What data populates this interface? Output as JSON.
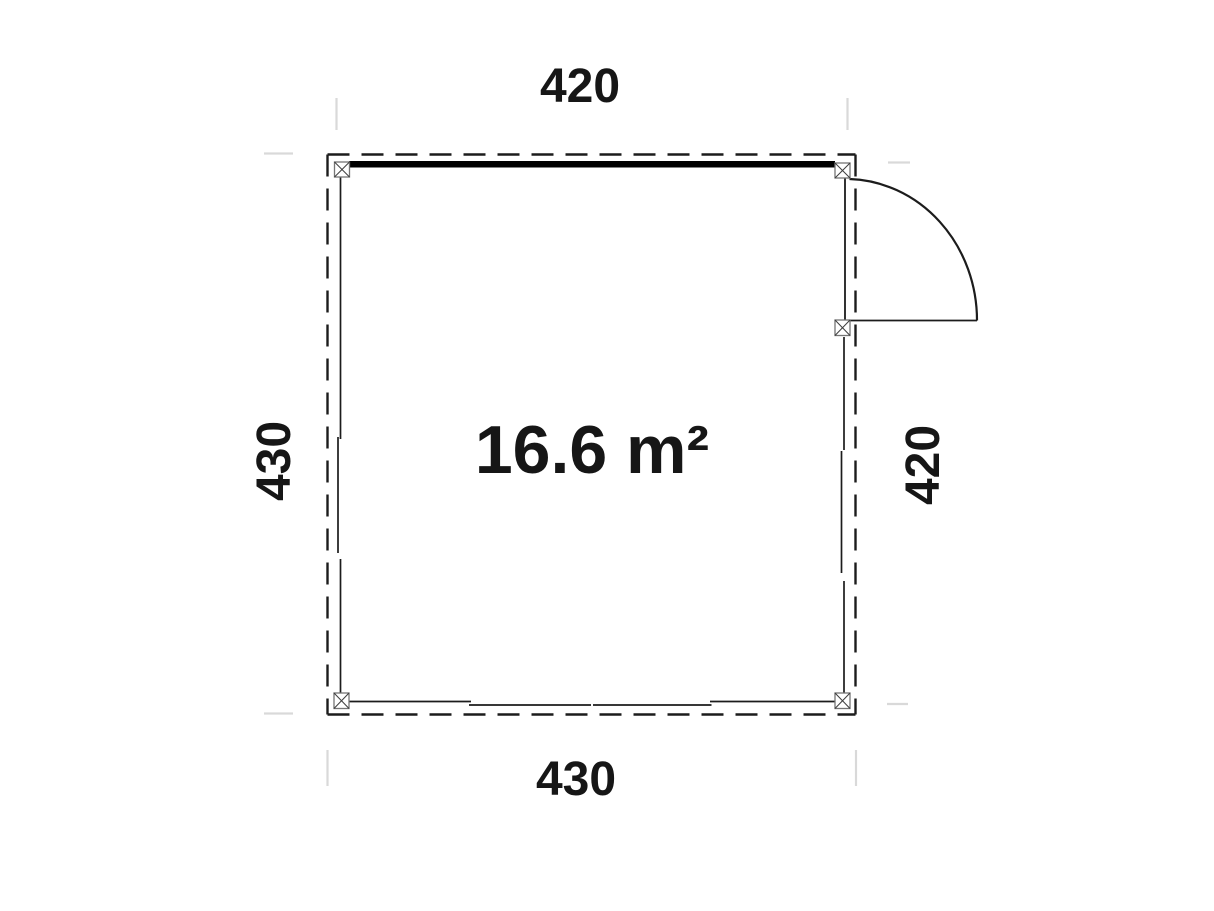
{
  "plan": {
    "area_label": "16.6 m²",
    "dimensions": {
      "top": "420",
      "bottom": "430",
      "left": "430",
      "right": "420"
    },
    "colors": {
      "line": "#1c1c1c",
      "thick_wall": "#000000",
      "post_border": "#757575",
      "post_cross": "#3d3d3d",
      "extension_tick": "#d9d9d9",
      "text": "#161616",
      "background": "#ffffff"
    }
  }
}
